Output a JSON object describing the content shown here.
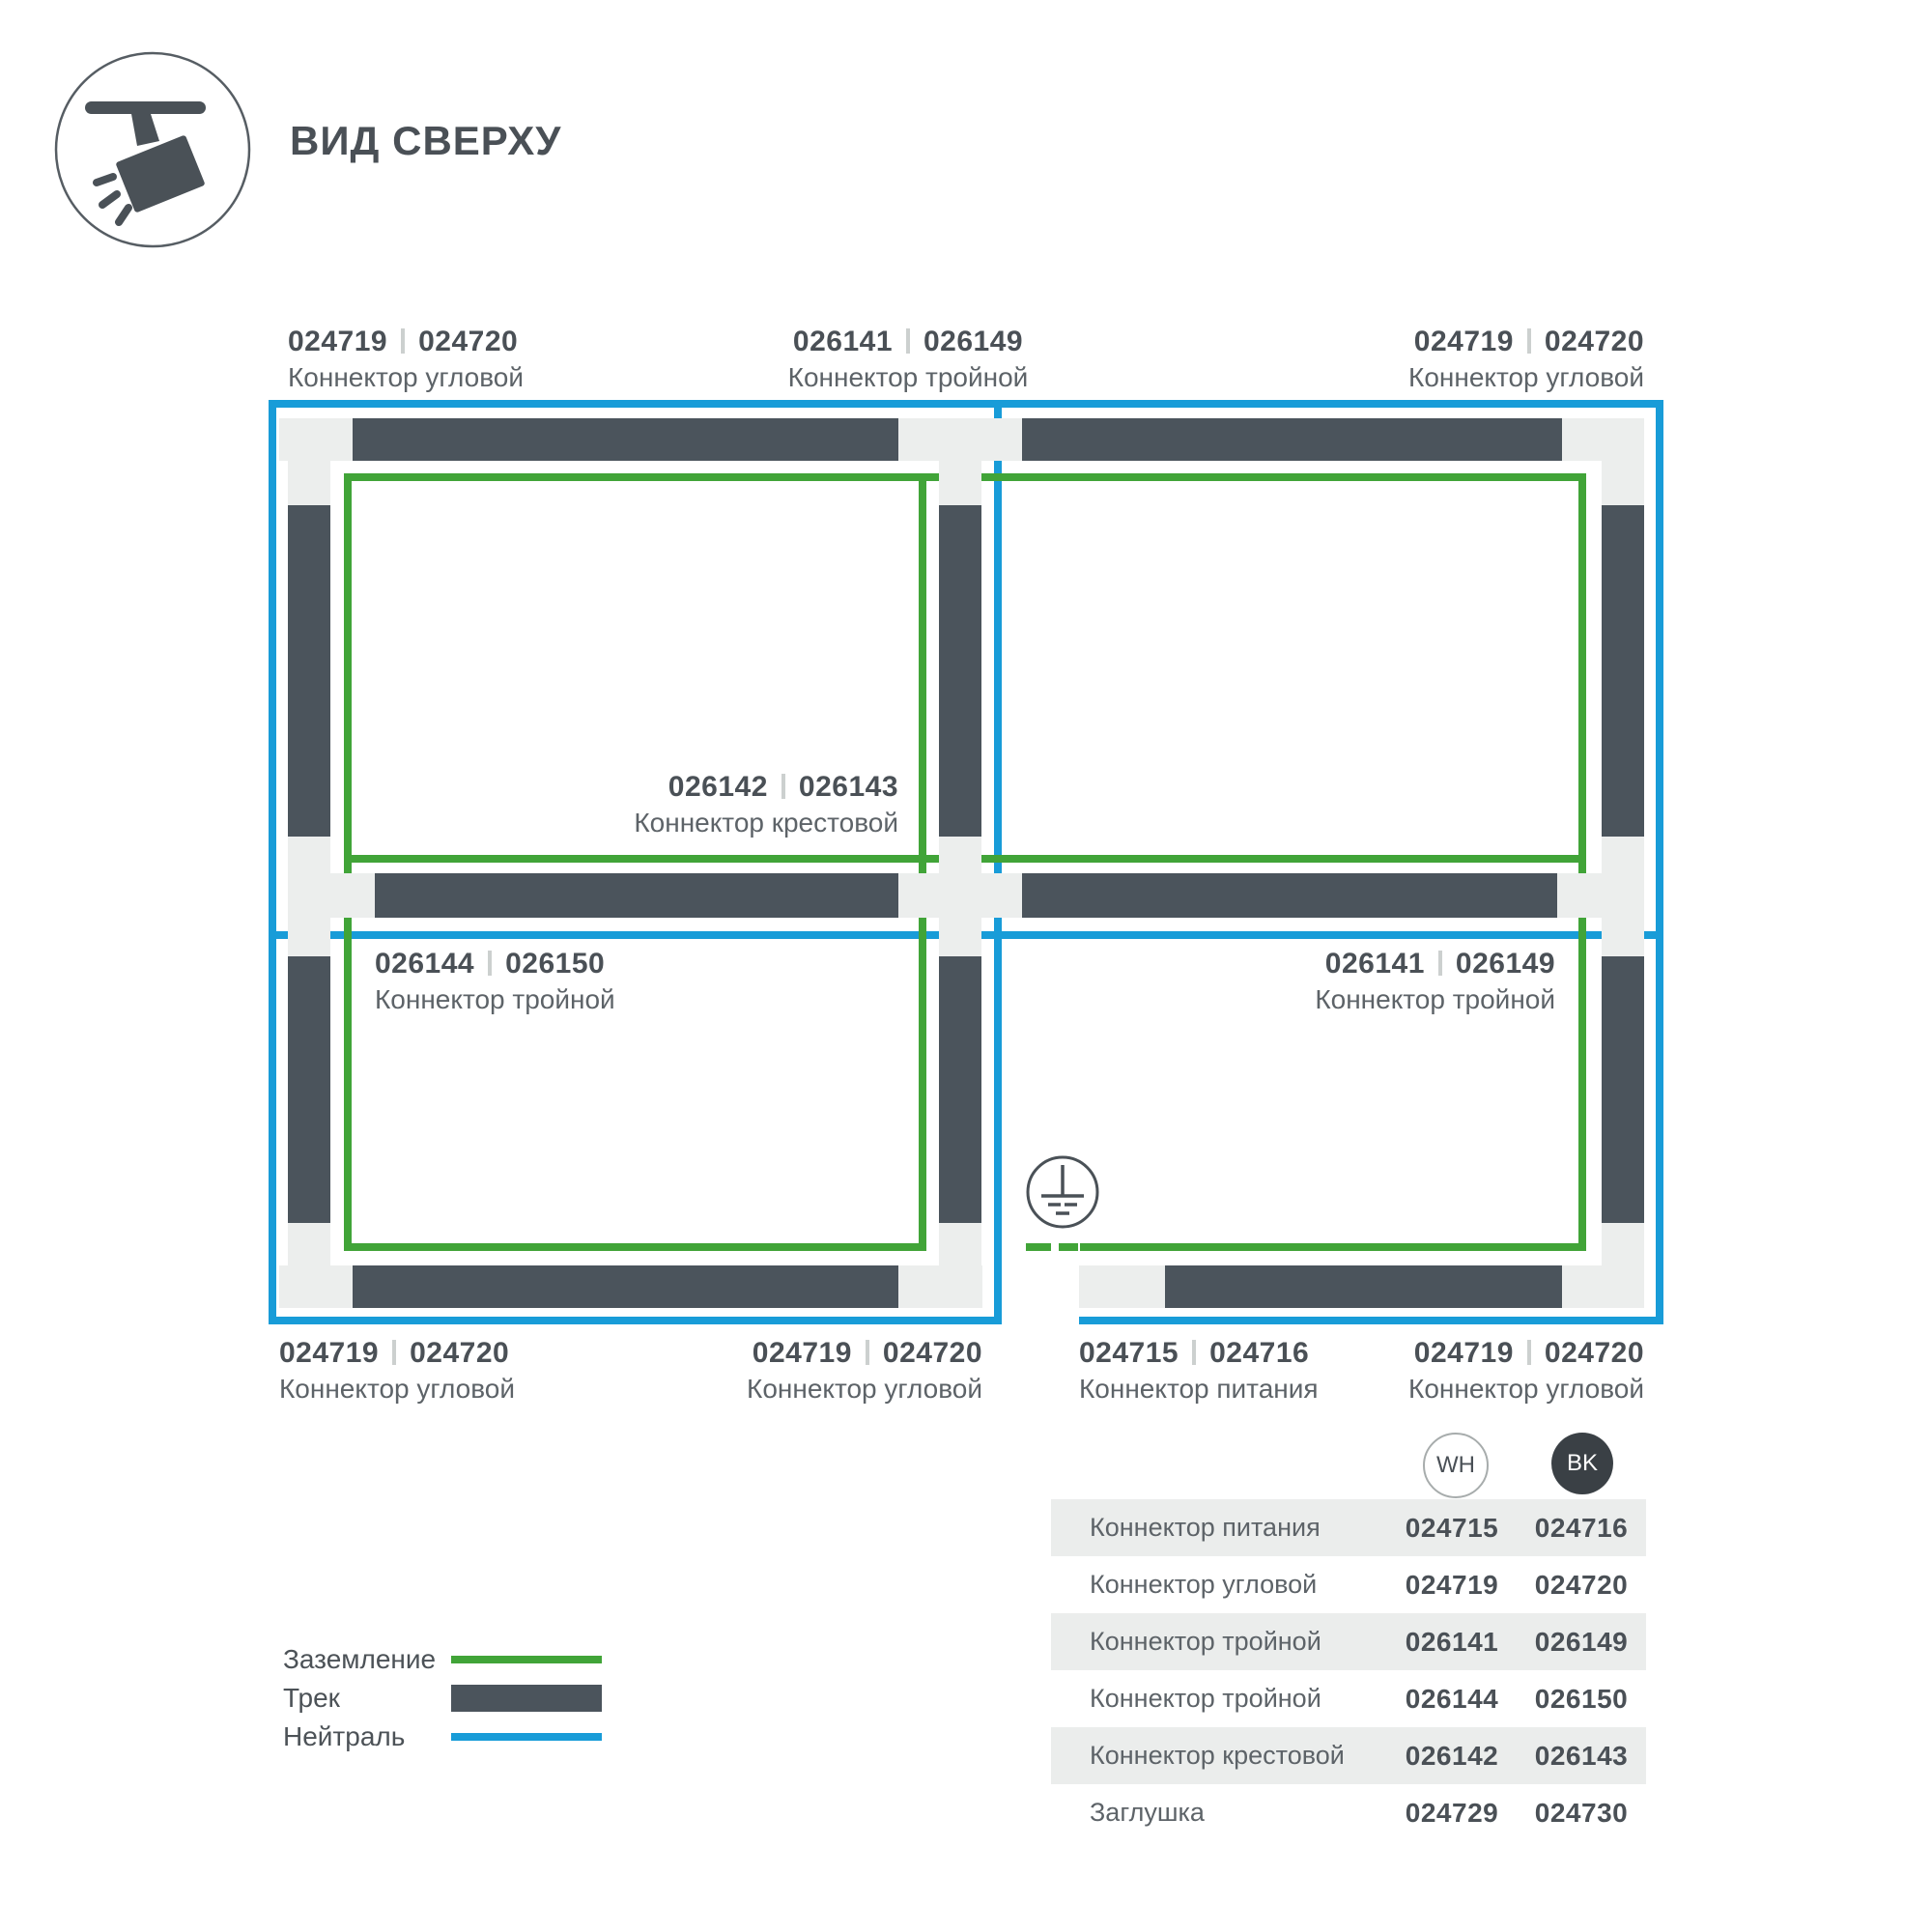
{
  "header": {
    "title": "ВИД СВЕРХУ",
    "icon": "track-spotlight-icon"
  },
  "colors": {
    "track": "#4b545c",
    "connector_block": "#eceeed",
    "ground_green": "#41a438",
    "neutral_blue": "#189cd8",
    "text_dark": "#4a5056",
    "text_gray": "#5d6368",
    "table_row_shade": "#ebedec",
    "bk_circle_fill": "#3a4045"
  },
  "diagram": {
    "ground_symbol": "earth-ground-symbol",
    "labels": [
      {
        "codes": [
          "024719",
          "024720"
        ],
        "name": "Коннектор угловой"
      },
      {
        "codes": [
          "026141",
          "026149"
        ],
        "name": "Коннектор тройной"
      },
      {
        "codes": [
          "024719",
          "024720"
        ],
        "name": "Коннектор угловой"
      },
      {
        "codes": [
          "026142",
          "026143"
        ],
        "name": "Коннектор крестовой"
      },
      {
        "codes": [
          "026144",
          "026150"
        ],
        "name": "Коннектор тройной"
      },
      {
        "codes": [
          "026141",
          "026149"
        ],
        "name": "Коннектор тройной"
      },
      {
        "codes": [
          "024719",
          "024720"
        ],
        "name": "Коннектор угловой"
      },
      {
        "codes": [
          "024719",
          "024720"
        ],
        "name": "Коннектор угловой"
      },
      {
        "codes": [
          "024715",
          "024716"
        ],
        "name": "Коннектор питания"
      },
      {
        "codes": [
          "024719",
          "024720"
        ],
        "name": "Коннектор угловой"
      }
    ]
  },
  "legend": {
    "items": [
      {
        "label": "Заземление",
        "swatch": "ground-line"
      },
      {
        "label": "Трек",
        "swatch": "track-bar"
      },
      {
        "label": "Нейтраль",
        "swatch": "neutral-line"
      }
    ]
  },
  "table": {
    "columns": [
      {
        "label": "WH"
      },
      {
        "label": "BK"
      }
    ],
    "rows": [
      {
        "name": "Коннектор питания",
        "wh": "024715",
        "bk": "024716"
      },
      {
        "name": "Коннектор угловой",
        "wh": "024719",
        "bk": "024720"
      },
      {
        "name": "Коннектор тройной",
        "wh": "026141",
        "bk": "026149"
      },
      {
        "name": "Коннектор тройной",
        "wh": "026144",
        "bk": "026150"
      },
      {
        "name": "Коннектор крестовой",
        "wh": "026142",
        "bk": "026143"
      },
      {
        "name": "Заглушка",
        "wh": "024729",
        "bk": "024730"
      }
    ]
  }
}
